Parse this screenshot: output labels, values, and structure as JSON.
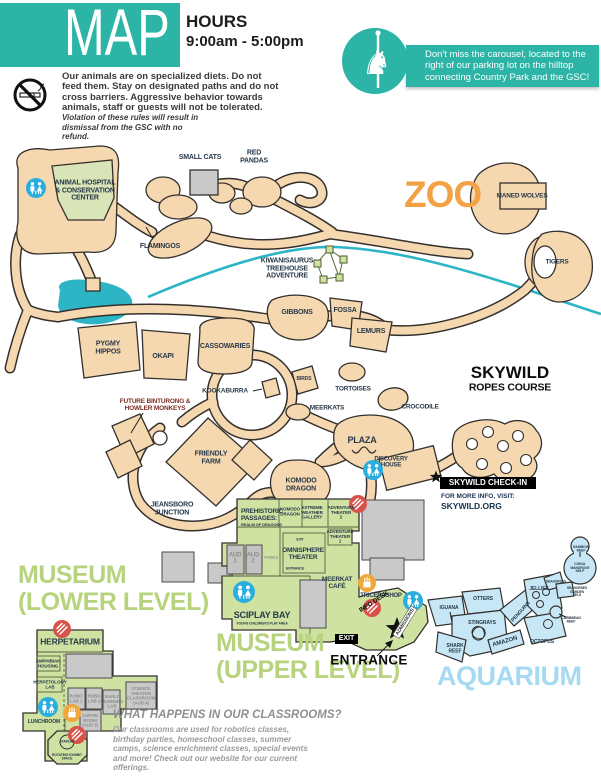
{
  "header": {
    "map_title": "MAP",
    "hours_label": "HOURS",
    "hours_value": "9:00am - 5:00pm"
  },
  "carousel_notice": {
    "text": "Don't miss the carousel, located to the right of our parking lot on the hilltop connecting Country Park and the GSC!"
  },
  "rules": {
    "main": "Our animals are on specialized diets. Do not feed them. Stay on designated paths and do not cross barriers. Aggressive behavior towards animals, staff or guests will not be tolerated.",
    "violation": "Violation of these rules will result in dismissal from the GSC with no refund."
  },
  "titles": {
    "zoo": "ZOO",
    "museum_lower": "MUSEUM\n(LOWER LEVEL)",
    "museum_upper": "MUSEUM\n(UPPER LEVEL)",
    "aquarium": "AQUARIUM",
    "skywild": "SKYWILD",
    "skywild_sub": "ROPES COURSE"
  },
  "zoo": {
    "animal_hospital": "ANIMAL HOSPITAL\n& CONSERVATION\nCENTER",
    "small_cats": "SMALL CATS",
    "red_pandas": "RED\nPANDAS",
    "flamingos": "FLAMINGOS",
    "kiwanisaurus": "KIWANISAURUS\nTREEHOUSE\nADVENTURE",
    "maned_wolves": "MANED WOLVES",
    "tigers": "TIGERS",
    "gibbons": "GIBBONS",
    "fossa": "FOSSA",
    "lemurs": "LEMURS",
    "pygmy_hippos": "PYGMY\nHIPPOS",
    "okapi": "OKAPI",
    "cassowaries": "CASSOWARIES",
    "birds": "BIRDS",
    "kookaburra": "KOOKABURRA",
    "tortoises": "TORTOISES",
    "meerkats": "MEERKATS",
    "crocodile": "CROCODILE",
    "future_exhibit": "FUTURE BINTURONG &\nHOWLER MONKEYS",
    "friendly_farm": "FRIENDLY\nFARM",
    "jeansboro_junction": "JEANSBORO\nJUNCTION",
    "plaza": "PLAZA",
    "komodo_dragon": "KOMODO\nDRAGON",
    "discovery_house": "DISCOVERY\nHOUSE"
  },
  "skywild": {
    "checkin": "SKYWILD CHECK-IN",
    "info_line1": "FOR MORE INFO, VISIT:",
    "info_line2": "SKYWILD.ORG"
  },
  "museum_upper": {
    "prehistoric": "PREHISTORIC\nPASSAGES:",
    "prehistoric_sub": "REALM OF DRAGONS",
    "komodo_room": "KOMODO\nDRAGON",
    "extreme_weather": "EXTREME\nWEATHER\nGALLERY",
    "adventure_theater_2": "ADVENTURE\nTHEATER\n2",
    "adventure_theater_1": "ADVENTURE\nTHEATER\n1",
    "aud_1": "AUD\n1",
    "aud_2": "AUD\n2",
    "fossils": "FOSSILS",
    "omnisphere": "OMNISPHERE\nTHEATER",
    "omni_exit": "EXIT",
    "omni_entrance": "ENTRANCE",
    "meerkat_cafe": "MEERKAT\nCAFÉ",
    "tricerashop": "TRICERASHOP",
    "sciplay_bay": "SCIPLAY BAY",
    "sciplay_sub": "YOUNG CHILDREN'S PLAY AREA"
  },
  "museum_lower": {
    "herpetarium": "HERPETARIUM",
    "amphibian_housing": "AMPHIBIAN\nHOUSING",
    "herpetology_lab": "HERPETOLOGY\nLAB",
    "robo_lab_1": "ROBO\nLAB 1",
    "robo_lab_2": "ROBO\nLAB 2",
    "early_learning_lab": "EARLY\nLEARNING\nLAB",
    "science_theater": "SCIENCE\nTHEATER\nCLASSROOM\n(AUD 4)",
    "safari_room": "SAFARI\nROOM\n(AUD 3)",
    "lunchroom": "LUNCHROOM",
    "starlab": "STARLAB",
    "rotating_exhibit": "ROTATING EXHIBIT\nSPACE"
  },
  "aquarium": {
    "iguana": "IGUANA",
    "otters": "OTTERS",
    "stingrays": "STINGRAYS",
    "shark_reef": "SHARK\nREEF",
    "jellies": "JELLIES",
    "penguins": "PENGUINS",
    "amazon": "AMAZON",
    "octopus": "OCTOPUS",
    "seahorses": "SEAHORSES",
    "coral_mangrove_kelp": "CORAL\nMANGROVE\nKELP",
    "rainbow_reef": "RAINBOW REEF",
    "garden_eels": "SEAHORSES\nGARDEN EELS",
    "caribbean_reef": "CARIBBEAN REEF"
  },
  "entrance_area": {
    "entrance": "ENTRANCE",
    "exit": "EXIT",
    "info_desk": "INFO DESK",
    "admissions": "ADMISSIONS"
  },
  "classrooms": {
    "heading": "WHAT HAPPENS IN OUR CLASSROOMS?",
    "body": "Our classrooms are used for robotics classes, birthday parties, homeschool classes, summer camps, science enrichment classes, special events and more! Check out our website for our current offerings."
  },
  "icons": {
    "no_smoking": "no-smoking",
    "carousel": "carousel-horse",
    "restroom": "restrooms",
    "dining": "food",
    "snacks": "snacks",
    "star": "location-star"
  },
  "colors": {
    "teal": "#2cb4a7",
    "path_tan": "#f6d8b0",
    "museum_green": "#cfe2a2",
    "room_gray": "#c9c9c9",
    "aquarium_blue": "#c7e7f7",
    "water": "#2db5c6",
    "zoo_orange": "#f2a245",
    "title_green": "#b7d37d",
    "title_blue": "#a6d9f2",
    "label_navy": "#27394a",
    "dining_red": "#d8524a",
    "snack_orange": "#f0a73a",
    "restroom_blue": "#2aaede"
  }
}
